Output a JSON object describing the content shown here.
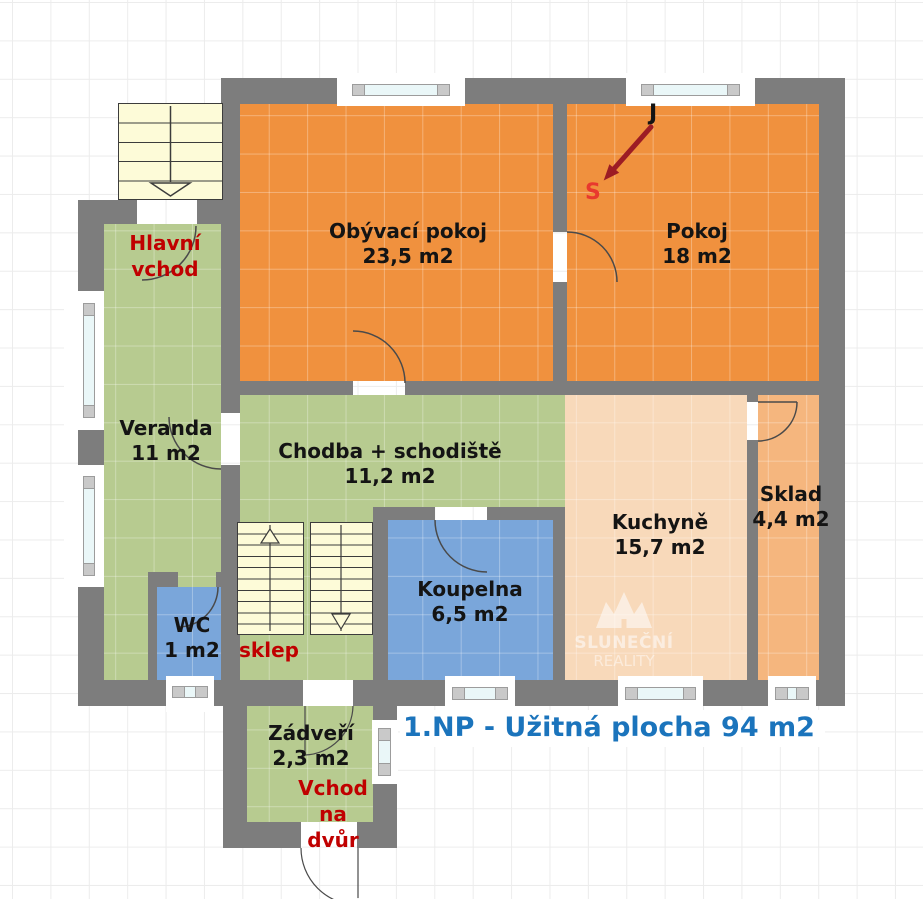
{
  "plan": {
    "title": "1.NP - Užitná plocha 94 m2",
    "compass": {
      "south": "J",
      "north": "S"
    },
    "watermark": {
      "line1": "SLUNEČNÍ",
      "line2": "REALITY"
    },
    "rooms": [
      {
        "name": "Obývací pokoj",
        "area": "23,5 m2",
        "color": "#f0913e"
      },
      {
        "name": "Pokoj",
        "area": "18 m2",
        "color": "#f0913e"
      },
      {
        "name": "Veranda",
        "area": "11 m2",
        "color": "#b7cb90"
      },
      {
        "name": "Chodba + schodiště",
        "area": "11,2 m2",
        "color": "#b7cb90"
      },
      {
        "name": "Kuchyně",
        "area": "15,7 m2",
        "color": "#f8d9ba"
      },
      {
        "name": "Sklad",
        "area": "4,4 m2",
        "color": "#f5b67e"
      },
      {
        "name": "Koupelna",
        "area": "6,5 m2",
        "color": "#7aa6da"
      },
      {
        "name": "WC",
        "area": "1 m2",
        "color": "#7aa6da"
      },
      {
        "name": "Zádveří",
        "area": "2,3 m2",
        "color": "#b7cb90"
      }
    ],
    "annotations": {
      "main_entrance_line1": "Hlavní",
      "main_entrance_line2": "vchod",
      "yard_entrance_line1": "Vchod",
      "yard_entrance_line2": "na",
      "yard_entrance_line3": "dvůr",
      "cellar": "sklep"
    },
    "colors": {
      "wall": "#7d7d7d",
      "grid": "#ececec",
      "room_orange": "#f0913e",
      "room_green": "#b7cb90",
      "room_peach": "#f8d9ba",
      "room_light_orange": "#f5b67e",
      "room_blue": "#7aa6da",
      "stairs_cream": "#fdfbd8",
      "red_label": "#c00000",
      "title_blue": "#1b74bc",
      "compass_arrow": "#9c1c24",
      "compass_north_red": "#e8392e",
      "window_glass": "#eaf7f8"
    }
  }
}
